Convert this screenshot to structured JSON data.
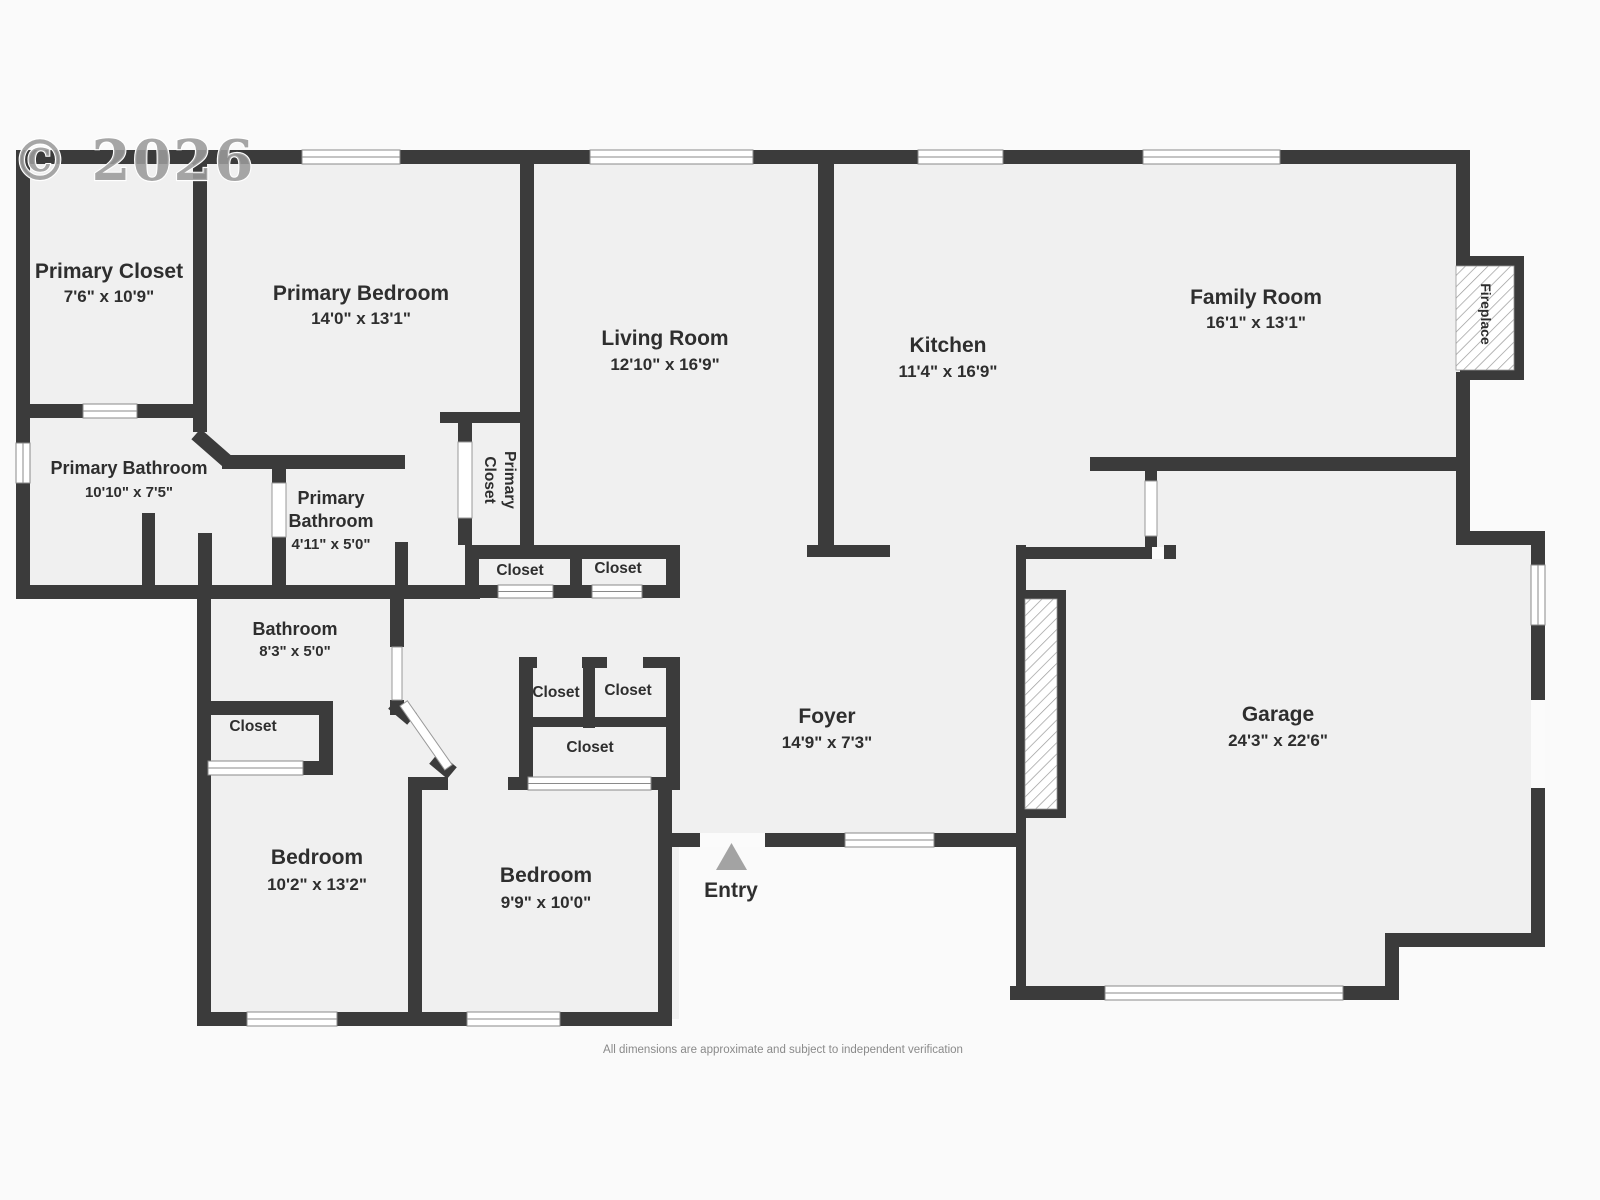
{
  "page": {
    "background": "#fafafa",
    "floor_color": "#f0f0f0",
    "wall_color": "#3b3b3b",
    "glyph_line_color": "#8a8a8a",
    "entry_arrow_color": "#a3a3a3"
  },
  "watermark": "© 2026",
  "disclaimer": "All dimensions are approximate and subject to independent verification",
  "rooms": [
    {
      "name": "Primary Closet",
      "dims": "7'6\" x 10'9\""
    },
    {
      "name": "Primary Bedroom",
      "dims": "14'0\" x 13'1\""
    },
    {
      "name": "Living Room",
      "dims": "12'10\" x 16'9\""
    },
    {
      "name": "Kitchen",
      "dims": "11'4\" x 16'9\""
    },
    {
      "name": "Family Room",
      "dims": "16'1\" x 13'1\""
    },
    {
      "name": "Primary Bathroom",
      "dims": "10'10\" x 7'5\""
    },
    {
      "name": "Primary",
      "name2": "Bathroom",
      "dims": "4'11\" x 5'0\""
    },
    {
      "name": "Bathroom",
      "dims": "8'3\" x 5'0\""
    },
    {
      "name": "Foyer",
      "dims": "14'9\" x 7'3\""
    },
    {
      "name": "Garage",
      "dims": "24'3\" x 22'6\""
    },
    {
      "name": "Bedroom",
      "dims": "10'2\" x 13'2\""
    },
    {
      "name": "Bedroom",
      "dims": "9'9\" x 10'0\""
    }
  ],
  "labels": {
    "closets": [
      "Closet",
      "Closet",
      "Closet",
      "Closet",
      "Closet",
      "Closet"
    ],
    "primary_closet_vertical": {
      "line1": "Primary",
      "line2": "Closet"
    },
    "fireplace": "Fireplace",
    "entry": "Entry"
  }
}
